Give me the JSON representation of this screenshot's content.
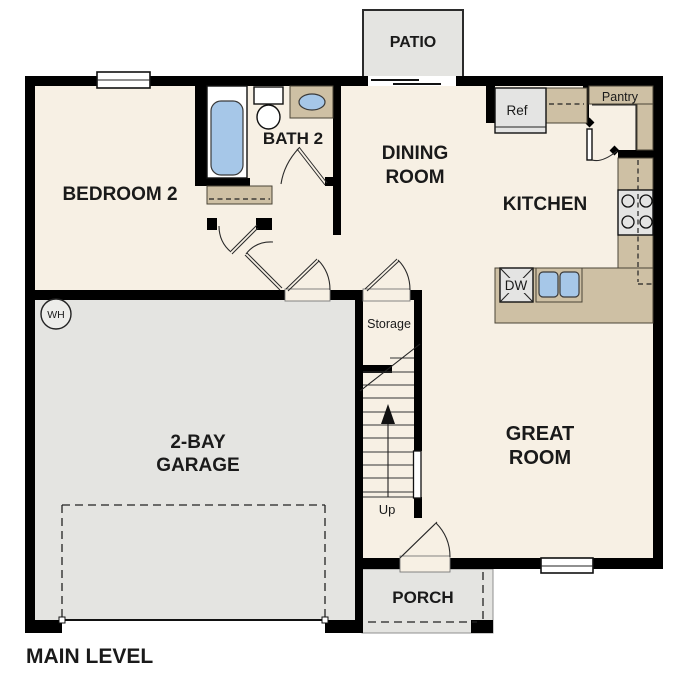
{
  "plan": {
    "level_label": "MAIN LEVEL",
    "rooms": {
      "bedroom2": "BEDROOM 2",
      "bath2": "BATH 2",
      "dining_line1": "DINING",
      "dining_line2": "ROOM",
      "kitchen": "KITCHEN",
      "great_line1": "GREAT",
      "great_line2": "ROOM",
      "garage_line1": "2-BAY",
      "garage_line2": "GARAGE",
      "patio": "PATIO",
      "porch": "PORCH",
      "storage": "Storage"
    },
    "fixtures": {
      "refrigerator": "Ref",
      "pantry": "Pantry",
      "dishwasher": "DW",
      "water_heater": "WH",
      "stairs_direction": "Up"
    }
  },
  "colors": {
    "background": "#FFFFFF",
    "floor": "#F7F0E4",
    "exterior_space": "#E4E4E1",
    "counter": "#CEC0A4",
    "fixture_blue": "#A6C7E8",
    "appliance": "#E4E4E3",
    "wall": "#000000",
    "text": "#1A1A1A"
  }
}
